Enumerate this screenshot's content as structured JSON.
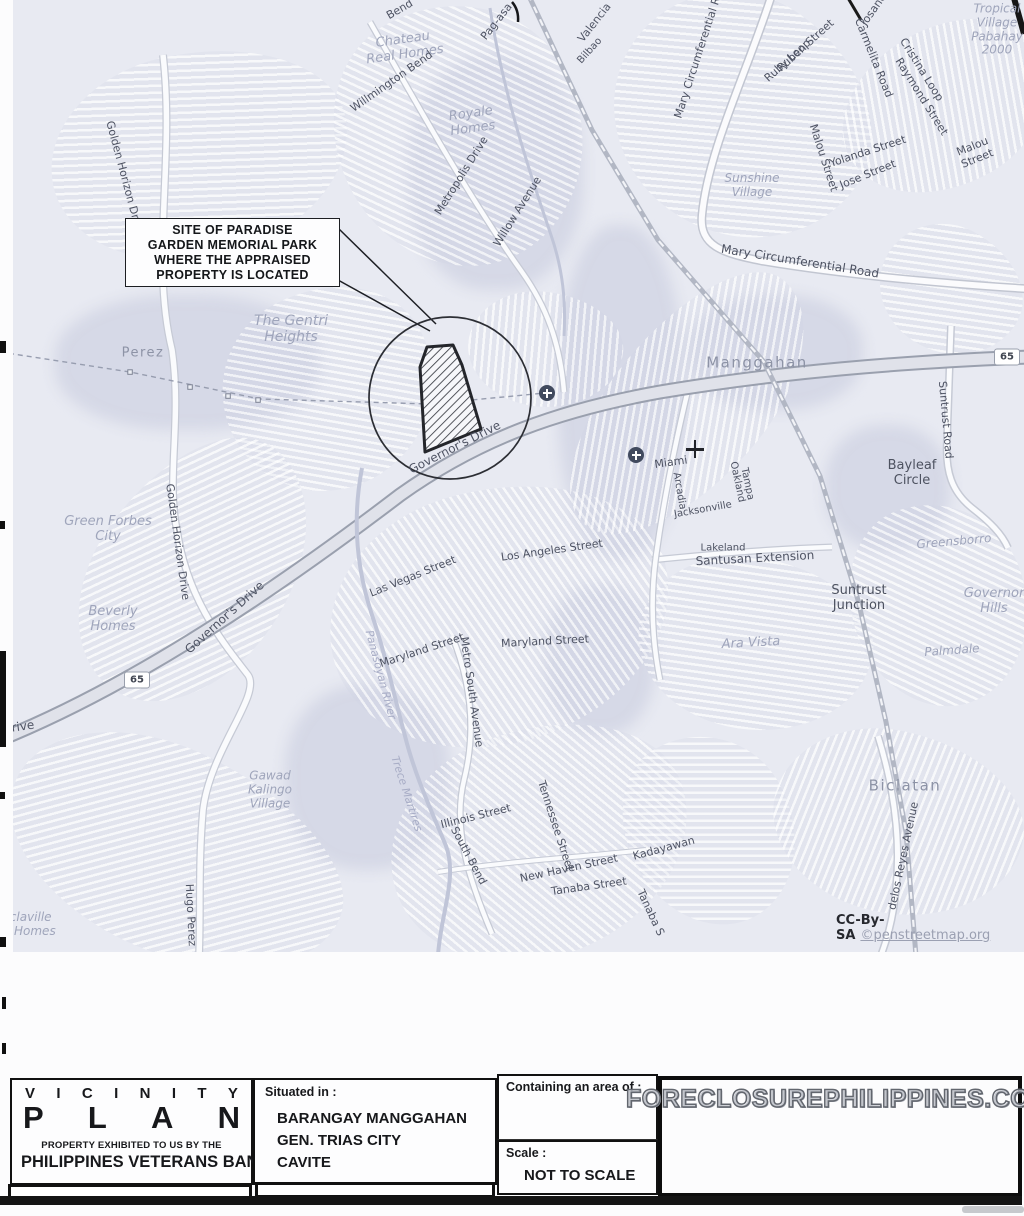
{
  "map": {
    "attribution": {
      "license": "CC-By-SA",
      "site": "©penstreetmap.org"
    },
    "highway_badge": "65",
    "badges": [
      {
        "x": 137,
        "y": 680
      },
      {
        "x": 1007,
        "y": 357
      }
    ],
    "hospital_icons": [
      {
        "x": 547,
        "y": 393
      },
      {
        "x": 636,
        "y": 455
      }
    ],
    "crosshair": {
      "x": 695,
      "y": 449
    },
    "labels": [
      {
        "t": "Bend",
        "x": 400,
        "y": 10,
        "r": -30,
        "s": 11,
        "c": "street"
      },
      {
        "t": "Pag-asa",
        "x": 497,
        "y": 22,
        "r": -52,
        "s": 11,
        "c": "street"
      },
      {
        "t": "Chateau\nReal Homes",
        "x": 404,
        "y": 48,
        "r": -8,
        "s": 13,
        "c": "area"
      },
      {
        "t": "Willmington Bend",
        "x": 392,
        "y": 82,
        "r": -35,
        "s": 11,
        "c": "street"
      },
      {
        "t": "Royale\nHomes",
        "x": 472,
        "y": 122,
        "r": -8,
        "s": 13,
        "c": "area"
      },
      {
        "t": "Metropolis Drive",
        "x": 462,
        "y": 176,
        "r": -58,
        "s": 11,
        "c": "street"
      },
      {
        "t": "Willow Avenue",
        "x": 518,
        "y": 212,
        "r": -58,
        "s": 11,
        "c": "street"
      },
      {
        "t": "Valencia",
        "x": 595,
        "y": 23,
        "r": -52,
        "s": 11,
        "c": "street"
      },
      {
        "t": "Bilbao",
        "x": 590,
        "y": 51,
        "r": -48,
        "s": 10,
        "c": "street"
      },
      {
        "t": "Mary Circumferential Ro",
        "x": 699,
        "y": 55,
        "r": -72,
        "s": 11,
        "c": "street"
      },
      {
        "t": "Josane",
        "x": 874,
        "y": 10,
        "r": -55,
        "s": 11,
        "c": "street"
      },
      {
        "t": "Ruben Street",
        "x": 806,
        "y": 46,
        "r": -42,
        "s": 11,
        "c": "street"
      },
      {
        "t": "Ruby Loop",
        "x": 788,
        "y": 61,
        "r": -42,
        "s": 11,
        "c": "street"
      },
      {
        "t": "Carmelita Road",
        "x": 873,
        "y": 58,
        "r": 68,
        "s": 11,
        "c": "street"
      },
      {
        "t": "Cristina Loop",
        "x": 921,
        "y": 70,
        "r": 58,
        "s": 11,
        "c": "street"
      },
      {
        "t": "Raymond Street",
        "x": 921,
        "y": 97,
        "r": 58,
        "s": 11,
        "c": "street"
      },
      {
        "t": "Tropical\nVillage\nPabahay\n2000",
        "x": 997,
        "y": 30,
        "r": 0,
        "s": 12,
        "c": "area"
      },
      {
        "t": "Malou Street",
        "x": 823,
        "y": 158,
        "r": 72,
        "s": 11,
        "c": "street"
      },
      {
        "t": "Yolanda Street",
        "x": 868,
        "y": 152,
        "r": -18,
        "s": 11,
        "c": "street"
      },
      {
        "t": "Jose Street",
        "x": 868,
        "y": 175,
        "r": -22,
        "s": 11,
        "c": "street"
      },
      {
        "t": "Malou Street",
        "x": 975,
        "y": 153,
        "r": -22,
        "s": 11,
        "c": "street"
      },
      {
        "t": "Sunshine\nVillage",
        "x": 752,
        "y": 186,
        "r": 0,
        "s": 12,
        "c": "area"
      },
      {
        "t": "Mary Circumferential Road",
        "x": 800,
        "y": 262,
        "r": 9,
        "s": 12,
        "c": "street"
      },
      {
        "t": "Manggahan",
        "x": 757,
        "y": 363,
        "r": 0,
        "s": 15,
        "c": "place"
      },
      {
        "t": "Suntrust Road",
        "x": 945,
        "y": 420,
        "r": 85,
        "s": 11,
        "c": "street"
      },
      {
        "t": "Bayleaf\nCircle",
        "x": 912,
        "y": 474,
        "r": 0,
        "s": 13,
        "c": "locality"
      },
      {
        "t": "Miami",
        "x": 671,
        "y": 463,
        "r": -8,
        "s": 11,
        "c": "street"
      },
      {
        "t": "Arcadia",
        "x": 679,
        "y": 491,
        "r": 80,
        "s": 10,
        "c": "street"
      },
      {
        "t": "Jacksonville",
        "x": 703,
        "y": 510,
        "r": -10,
        "s": 10,
        "c": "street"
      },
      {
        "t": "Oakland",
        "x": 737,
        "y": 482,
        "r": 78,
        "s": 10,
        "c": "street"
      },
      {
        "t": "Tampa",
        "x": 747,
        "y": 484,
        "r": 78,
        "s": 10,
        "c": "street"
      },
      {
        "t": "Lakeland",
        "x": 723,
        "y": 548,
        "r": 0,
        "s": 10,
        "c": "street"
      },
      {
        "t": "Santusan Extension",
        "x": 755,
        "y": 559,
        "r": -3,
        "s": 12,
        "c": "street"
      },
      {
        "t": "Greensborro",
        "x": 954,
        "y": 542,
        "r": -5,
        "s": 12,
        "c": "area"
      },
      {
        "t": "Suntrust\nJunction",
        "x": 859,
        "y": 599,
        "r": 0,
        "s": 13,
        "c": "locality"
      },
      {
        "t": "Governor\nHills",
        "x": 994,
        "y": 602,
        "r": 0,
        "s": 13,
        "c": "area"
      },
      {
        "t": "Ara Vista",
        "x": 751,
        "y": 644,
        "r": -3,
        "s": 13,
        "c": "area"
      },
      {
        "t": "Palmdale",
        "x": 952,
        "y": 651,
        "r": -4,
        "s": 12,
        "c": "area"
      },
      {
        "t": "Perez",
        "x": 143,
        "y": 354,
        "r": 0,
        "s": 13,
        "c": "place"
      },
      {
        "t": "The Gentri\nHeights",
        "x": 291,
        "y": 329,
        "r": 0,
        "s": 14,
        "c": "area"
      },
      {
        "t": "Golden Horizon Drive",
        "x": 124,
        "y": 178,
        "r": 75,
        "s": 11,
        "c": "street"
      },
      {
        "t": "Golden Horizon Drive",
        "x": 177,
        "y": 542,
        "r": 82,
        "s": 11,
        "c": "street"
      },
      {
        "t": "Green Forbes\nCity",
        "x": 108,
        "y": 530,
        "r": 0,
        "s": 13,
        "c": "area"
      },
      {
        "t": "Beverly\nHomes",
        "x": 113,
        "y": 620,
        "r": 0,
        "s": 13,
        "c": "area"
      },
      {
        "t": "Governor's Drive",
        "x": 455,
        "y": 448,
        "r": -27,
        "s": 12,
        "c": "street"
      },
      {
        "t": "Governor's Drive",
        "x": 225,
        "y": 618,
        "r": -42,
        "s": 12,
        "c": "street"
      },
      {
        "t": "rive",
        "x": 23,
        "y": 727,
        "r": -8,
        "s": 12,
        "c": "street"
      },
      {
        "t": "Gawad\nKalingo\nVillage",
        "x": 270,
        "y": 790,
        "r": 0,
        "s": 12,
        "c": "area"
      },
      {
        "t": "Hugo Perez",
        "x": 190,
        "y": 915,
        "r": 87,
        "s": 11,
        "c": "street"
      },
      {
        "t": "aclaville\nrk Homes",
        "x": 27,
        "y": 925,
        "r": 0,
        "s": 12,
        "c": "area"
      },
      {
        "t": "Las Vegas Street",
        "x": 413,
        "y": 577,
        "r": -22,
        "s": 11,
        "c": "street"
      },
      {
        "t": "Los Angeles Street",
        "x": 552,
        "y": 551,
        "r": -8,
        "s": 11,
        "c": "street"
      },
      {
        "t": "Maryland Street",
        "x": 422,
        "y": 651,
        "r": -18,
        "s": 11,
        "c": "street"
      },
      {
        "t": "Maryland Street",
        "x": 545,
        "y": 642,
        "r": -3,
        "s": 11,
        "c": "street"
      },
      {
        "t": "Metro South Avenue",
        "x": 471,
        "y": 692,
        "r": 82,
        "s": 11,
        "c": "street"
      },
      {
        "t": "Panasoyan River",
        "x": 380,
        "y": 675,
        "r": 75,
        "s": 11,
        "c": "water"
      },
      {
        "t": "Trece Martires",
        "x": 406,
        "y": 794,
        "r": 72,
        "s": 11,
        "c": "water"
      },
      {
        "t": "Illinois Street",
        "x": 476,
        "y": 817,
        "r": -14,
        "s": 11,
        "c": "street"
      },
      {
        "t": "South Bend",
        "x": 468,
        "y": 856,
        "r": 62,
        "s": 11,
        "c": "street"
      },
      {
        "t": "Tennessee Street",
        "x": 555,
        "y": 826,
        "r": 72,
        "s": 11,
        "c": "street"
      },
      {
        "t": "New Haven Street",
        "x": 569,
        "y": 869,
        "r": -12,
        "s": 11,
        "c": "street"
      },
      {
        "t": "Tanaba Street",
        "x": 589,
        "y": 887,
        "r": -8,
        "s": 11,
        "c": "street"
      },
      {
        "t": "Tanaba S",
        "x": 650,
        "y": 913,
        "r": 65,
        "s": 11,
        "c": "street"
      },
      {
        "t": "Kadayawan",
        "x": 664,
        "y": 849,
        "r": -15,
        "s": 11,
        "c": "street"
      },
      {
        "t": "Biclatan",
        "x": 905,
        "y": 786,
        "r": 0,
        "s": 15,
        "c": "place"
      },
      {
        "t": "delos Reyes Avenue",
        "x": 904,
        "y": 856,
        "r": -78,
        "s": 11,
        "c": "street"
      }
    ]
  },
  "callout": {
    "lines": [
      "SITE OF PARADISE",
      "GARDEN MEMORIAL PARK",
      "WHERE THE APPRAISED",
      "PROPERTY IS LOCATED"
    ]
  },
  "title_block": {
    "title_line1": "VICINITY",
    "title_line2": "PLAN",
    "subtitle_small": "PROPERTY EXHIBITED TO US BY THE",
    "subtitle_large": "PHILIPPINES VETERANS BANK",
    "situated_label": "Situated in :",
    "situated_lines": [
      "BARANGAY MANGGAHAN",
      "GEN. TRIAS CITY",
      "CAVITE"
    ],
    "area_label": "Containing an area of :",
    "scale_label": "Scale :",
    "scale_value": "NOT TO SCALE",
    "watermark": "FORECLOSUREPHILIPPINES.COM"
  }
}
